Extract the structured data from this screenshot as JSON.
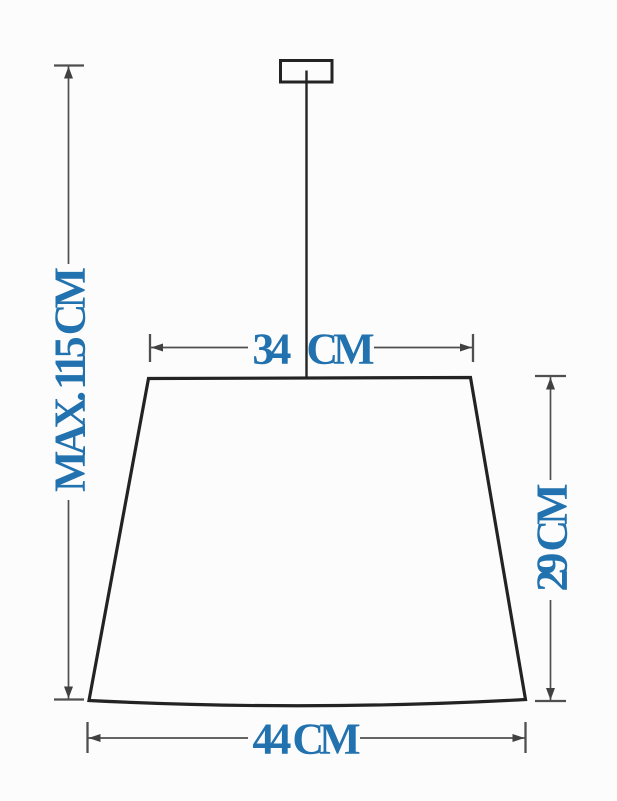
{
  "diagram": {
    "colors": {
      "label": "#2172ae",
      "outline": "#232323",
      "dimension_lines": "#4f4f4f",
      "background": "#fcfcfc"
    },
    "dimensions": {
      "max_height": {
        "label": "MAX. 115 CM",
        "qualifier": "MAX.",
        "value": 115,
        "unit": "CM"
      },
      "top_width": {
        "label": "34 CM",
        "value": 34,
        "unit": "CM"
      },
      "shade_height": {
        "label": "29 CM",
        "value": 29,
        "unit": "CM"
      },
      "bottom_width": {
        "label": "44 CM",
        "value": 44,
        "unit": "CM"
      }
    }
  }
}
